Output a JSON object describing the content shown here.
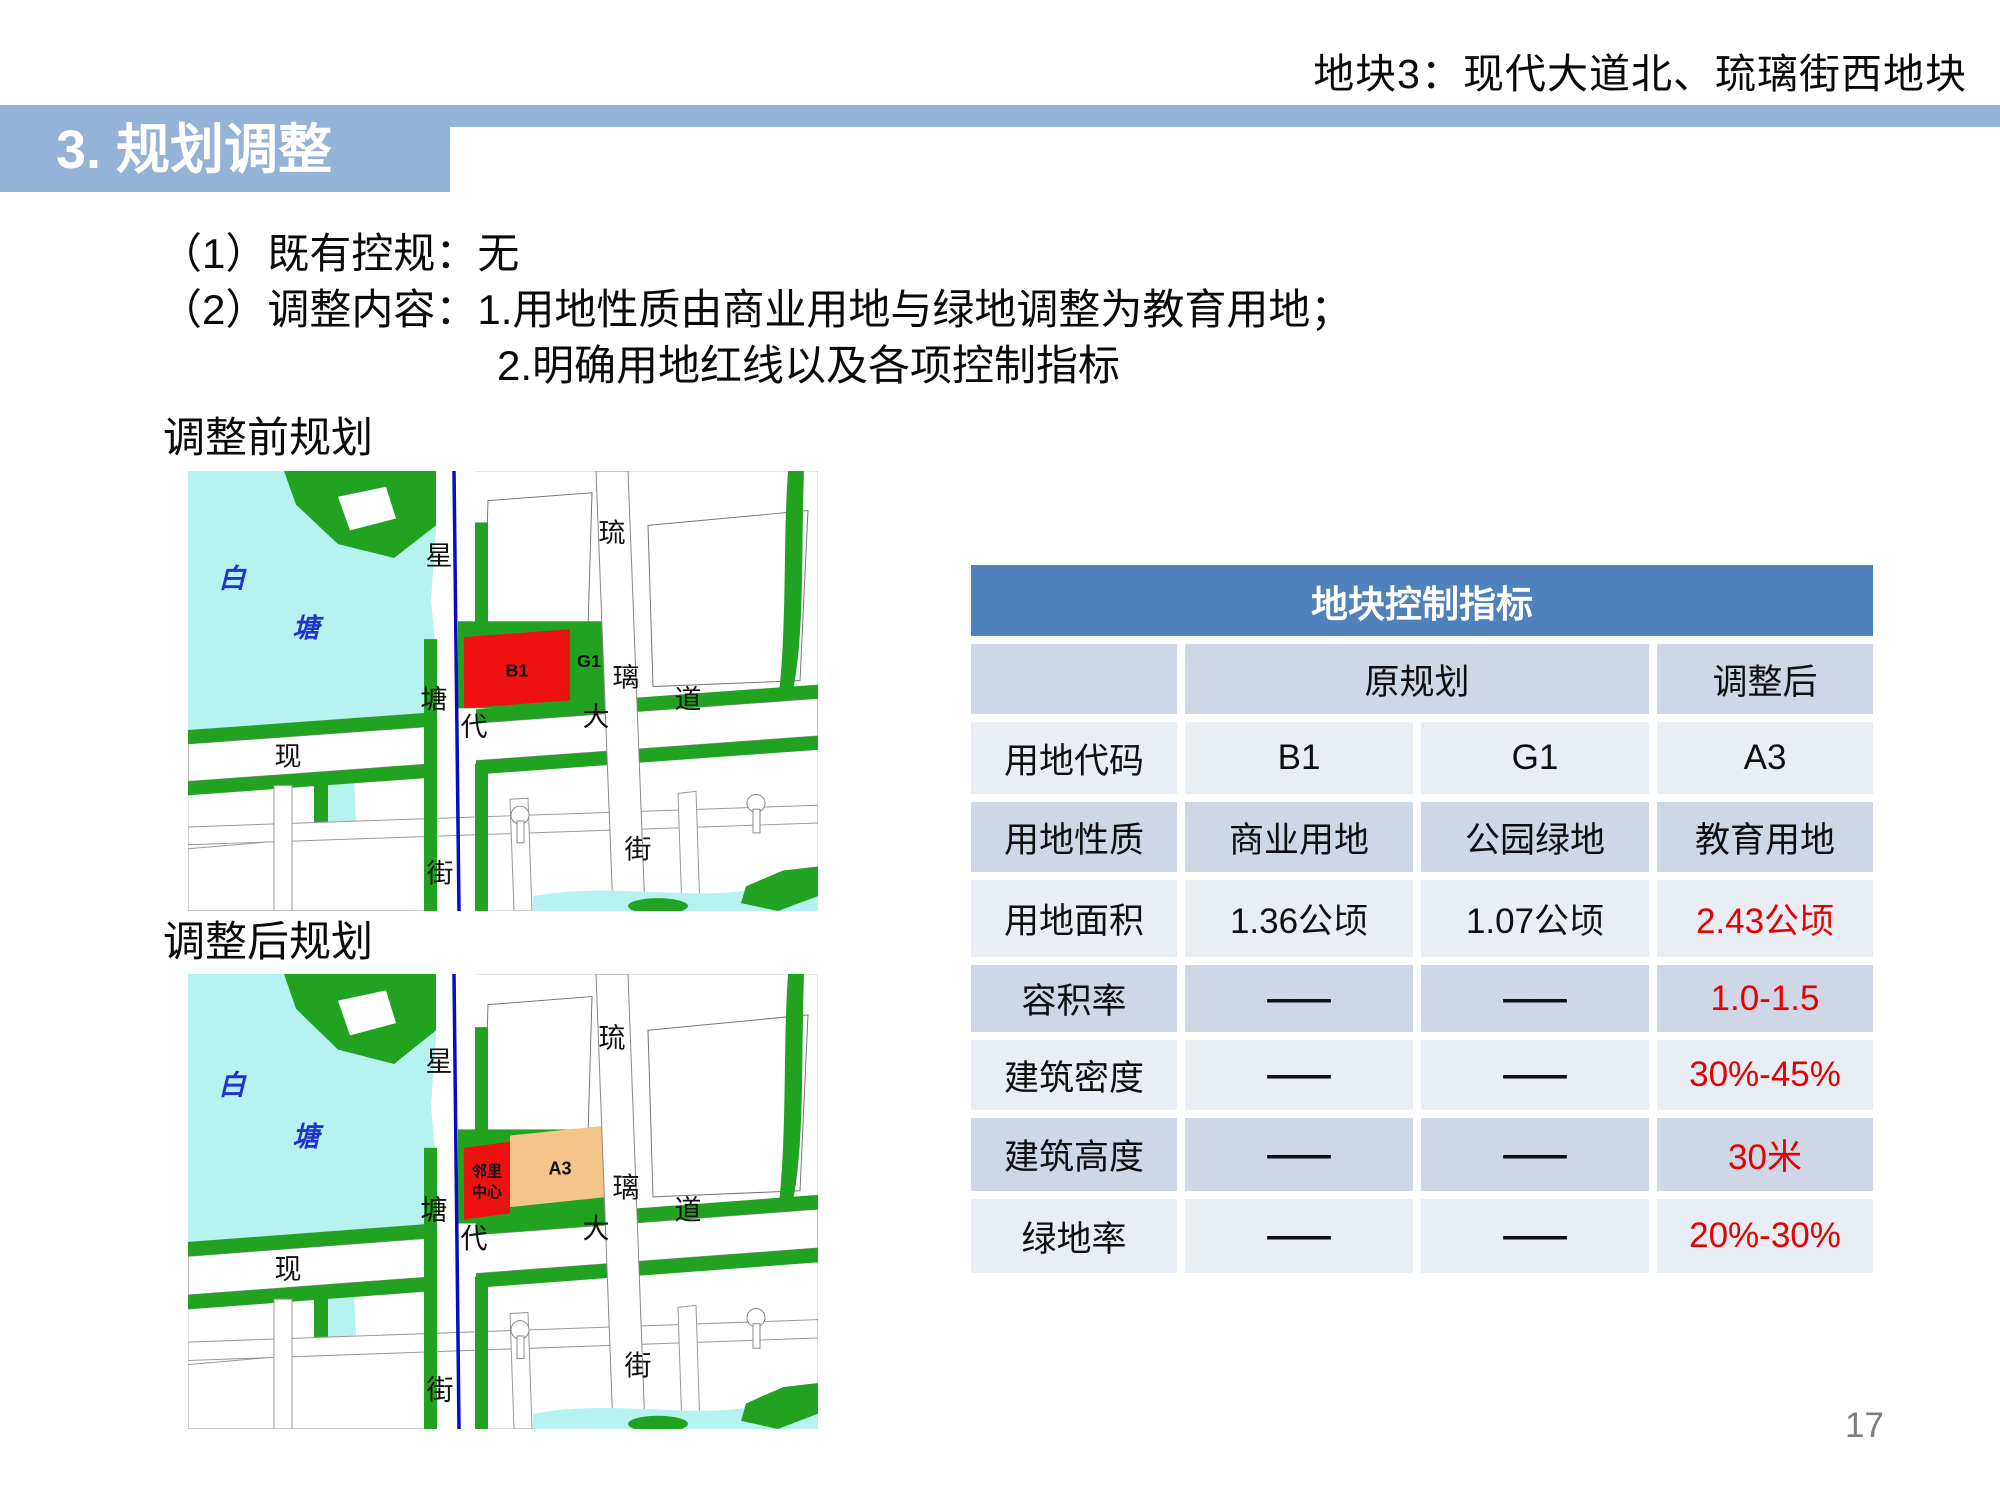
{
  "header": {
    "title": "地块3：现代大道北、琉璃街西地块"
  },
  "section": {
    "title": "3. 规划调整"
  },
  "content": {
    "line1": "（1）既有控规：无",
    "line2": "（2）调整内容：1.用地性质由商业用地与绿地调整为教育用地；",
    "line3": "2.明确用地红线以及各项控制指标"
  },
  "maps": {
    "before_label": "调整前规划",
    "after_label": "调整后规划",
    "lake": {
      "c1": "白",
      "c2": "塘"
    },
    "road_xingtang": {
      "c1": "星",
      "c2": "塘",
      "c3": "街"
    },
    "road_xiandai": {
      "c1": "现",
      "c2": "代",
      "c3": "大",
      "c4": "道"
    },
    "road_liuli": {
      "c1": "琉",
      "c2": "璃",
      "c3": "街"
    },
    "before_parcels": {
      "b1": "B1",
      "g1": "G1"
    },
    "after_parcels": {
      "neighborhood_line1": "邻里",
      "neighborhood_line2": "中心",
      "a3": "A3"
    }
  },
  "table": {
    "title": "地块控制指标",
    "col_headers": {
      "original": "原规划",
      "adjusted": "调整后"
    },
    "rows": [
      {
        "label": "用地代码",
        "orig1": "B1",
        "orig2": "G1",
        "adjusted": "A3",
        "adjusted_red": false
      },
      {
        "label": "用地性质",
        "orig1": "商业用地",
        "orig2": "公园绿地",
        "adjusted": "教育用地",
        "adjusted_red": false
      },
      {
        "label": "用地面积",
        "orig1": "1.36公顷",
        "orig2": "1.07公顷",
        "adjusted": "2.43公顷",
        "adjusted_red": true
      },
      {
        "label": "容积率",
        "orig1": "——",
        "orig2": "——",
        "adjusted": "1.0-1.5",
        "adjusted_red": true
      },
      {
        "label": "建筑密度",
        "orig1": "——",
        "orig2": "——",
        "adjusted": "30%-45%",
        "adjusted_red": true
      },
      {
        "label": "建筑高度",
        "orig1": "——",
        "orig2": "——",
        "adjusted": "30米",
        "adjusted_red": true
      },
      {
        "label": "绿地率",
        "orig1": "——",
        "orig2": "——",
        "adjusted": "20%-30%",
        "adjusted_red": true
      }
    ]
  },
  "page_number": "17",
  "colors": {
    "title_bar": "#95b3d7",
    "table_header_blue": "#4f81bd",
    "band_light": "#e9edf4",
    "band_dark": "#cfd6e6",
    "highlight_red": "#e60000",
    "map_green": "#21a321",
    "map_water": "#b6f2f0",
    "map_parcel_red": "#ee1111",
    "map_parcel_orange": "#f5c488",
    "map_boundary_blue": "#0a0ac4"
  }
}
